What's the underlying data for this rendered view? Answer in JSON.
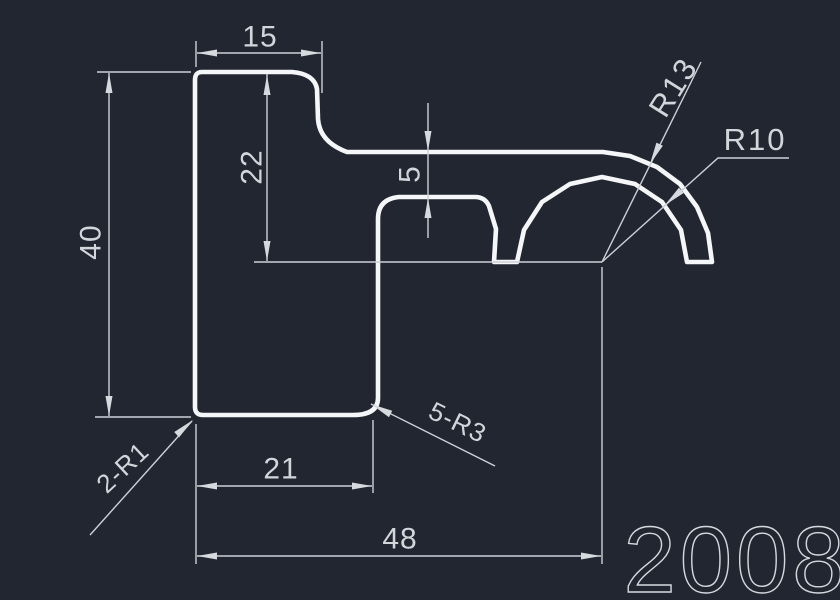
{
  "drawing": {
    "part_number": "2008",
    "dimensions": {
      "top_width": "15",
      "overall_height": "40",
      "upper_height": "22",
      "rib_gap": "5",
      "base_width": "21",
      "overall_width": "48"
    },
    "radii": {
      "outer_arc": "R13",
      "inner_arc": "R10",
      "corners_bottom_left": "2-R1",
      "corners_bottom_right": "5-R3"
    },
    "colors": {
      "background": "#222631",
      "profile_line": "#f4f6f8",
      "dimension_line": "#ccd1d7",
      "text": "#d2d6db"
    }
  }
}
